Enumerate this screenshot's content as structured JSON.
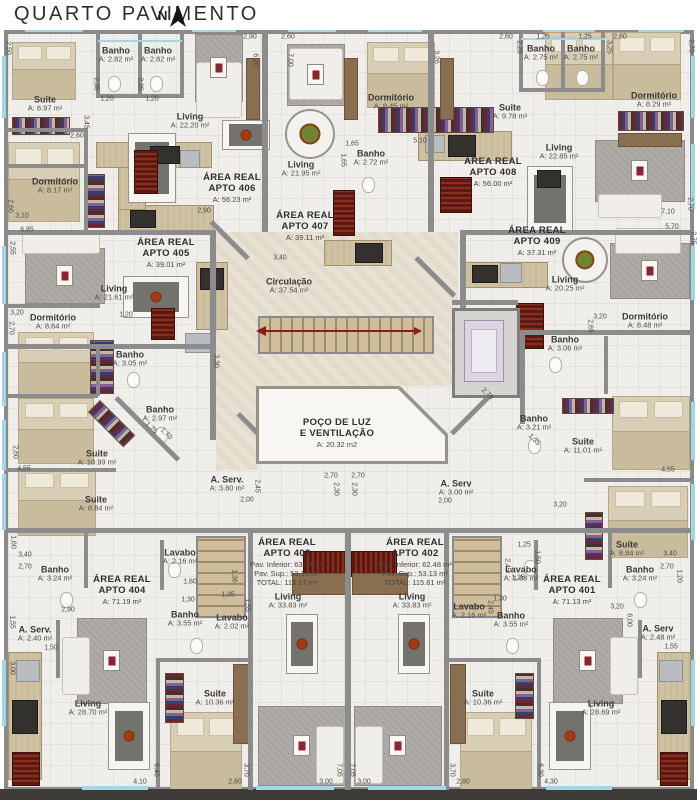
{
  "header": {
    "title": "QUARTO PAVIMENTO",
    "north_label": "N"
  },
  "palette": {
    "wall": "#8c8c8c",
    "floor": "#efeeea",
    "circulation": "#e8e2d5",
    "window": "#a4d7e6",
    "stair": "#cfbd9b",
    "arrow_red": "#8e1b12",
    "label_text": "#3a3a3a"
  },
  "rooms": [
    {
      "name": "Suite",
      "area": "A: 8.97 m²",
      "x": 45,
      "y": 104
    },
    {
      "name": "Banho",
      "area": "A: 2.82 m²",
      "x": 116,
      "y": 55
    },
    {
      "name": "Banho",
      "area": "A: 2.82 m²",
      "x": 158,
      "y": 55
    },
    {
      "name": "Living",
      "area": "A: 22.20 m²",
      "x": 190,
      "y": 121
    },
    {
      "name": "Dormitório",
      "area": "A: 8.17 m²",
      "x": 55,
      "y": 186
    },
    {
      "name": "Living",
      "area": "A: 21.95 m²",
      "x": 301,
      "y": 169
    },
    {
      "name": "Banho",
      "area": "A: 2.72 m²",
      "x": 371,
      "y": 158
    },
    {
      "name": "Dormitório",
      "area": "A: 8.45 m²",
      "x": 391,
      "y": 102
    },
    {
      "name": "Suite",
      "area": "A: 9.78 m²",
      "x": 510,
      "y": 112
    },
    {
      "name": "Banho",
      "area": "A: 2.75 m²",
      "x": 541,
      "y": 53
    },
    {
      "name": "Banho",
      "area": "A: 2.75 m²",
      "x": 581,
      "y": 53
    },
    {
      "name": "Dormitório",
      "area": "A: 8.29 m²",
      "x": 654,
      "y": 100
    },
    {
      "name": "Living",
      "area": "A: 22.85 m²",
      "x": 559,
      "y": 152
    },
    {
      "name": "Living",
      "area": "A: 21.61 m²",
      "x": 114,
      "y": 293
    },
    {
      "name": "Circulação",
      "area": "A: 37.54 m²",
      "x": 289,
      "y": 286
    },
    {
      "name": "Living",
      "area": "A: 20.25 m²",
      "x": 565,
      "y": 284
    },
    {
      "name": "Dormitório",
      "area": "A: 8.64 m²",
      "x": 53,
      "y": 322
    },
    {
      "name": "Banho",
      "area": "A: 3.05 m²",
      "x": 130,
      "y": 359
    },
    {
      "name": "Banho",
      "area": "A: 2.97 m²",
      "x": 160,
      "y": 414
    },
    {
      "name": "Banho",
      "area": "A: 3.06 m²",
      "x": 565,
      "y": 344
    },
    {
      "name": "Dormitório",
      "area": "A: 8.48 m²",
      "x": 645,
      "y": 321
    },
    {
      "name": "Banho",
      "area": "A: 3.21 m²",
      "x": 534,
      "y": 423
    },
    {
      "name": "Suite",
      "area": "A: 10.99 m²",
      "x": 97,
      "y": 458
    },
    {
      "name": "Suite",
      "area": "A: 11.01 m²",
      "x": 583,
      "y": 446
    },
    {
      "name": "A. Serv.",
      "area": "A: 3.80 m²",
      "x": 227,
      "y": 484
    },
    {
      "name": "A. Serv",
      "area": "A: 3.00 m²",
      "x": 456,
      "y": 488
    },
    {
      "name": "Suite",
      "area": "A: 8.84 m²",
      "x": 96,
      "y": 504
    },
    {
      "name": "Suite",
      "area": "A: 8.84 m²",
      "x": 627,
      "y": 549
    },
    {
      "name": "Lavabo",
      "area": "A: 2.16 m²",
      "x": 180,
      "y": 557
    },
    {
      "name": "Banho",
      "area": "A: 3.24 m²",
      "x": 55,
      "y": 574
    },
    {
      "name": "Banho",
      "area": "A: 3.24 m²",
      "x": 640,
      "y": 574
    },
    {
      "name": "Lavabo",
      "area": "A: 1.88 m²",
      "x": 521,
      "y": 574
    },
    {
      "name": "Banho",
      "area": "A: 3.55 m²",
      "x": 185,
      "y": 619
    },
    {
      "name": "Banho",
      "area": "A: 3.55 m²",
      "x": 511,
      "y": 620
    },
    {
      "name": "Lavabo",
      "area": "A: 2.02 m²",
      "x": 232,
      "y": 622
    },
    {
      "name": "Lavabo",
      "area": "A: 2.16 m²",
      "x": 469,
      "y": 611
    },
    {
      "name": "A. Serv.",
      "area": "A: 2.40 m²",
      "x": 35,
      "y": 634
    },
    {
      "name": "A. Serv",
      "area": "A: 2.48 m²",
      "x": 658,
      "y": 633
    },
    {
      "name": "Living",
      "area": "A: 33.83 m²",
      "x": 288,
      "y": 601
    },
    {
      "name": "Living",
      "area": "A: 33.83 m²",
      "x": 412,
      "y": 601
    },
    {
      "name": "Living",
      "area": "A: 28.70 m²",
      "x": 88,
      "y": 708
    },
    {
      "name": "Living",
      "area": "A: 28.69 m²",
      "x": 601,
      "y": 708
    },
    {
      "name": "Suite",
      "area": "A: 10.36 m²",
      "x": 215,
      "y": 698
    },
    {
      "name": "Suite",
      "area": "A: 10.36 m²",
      "x": 483,
      "y": 698
    }
  ],
  "apartments": [
    {
      "lines": [
        "ÁREA REAL",
        "APTO 406",
        "A: 56.23 m²"
      ],
      "x": 232,
      "y": 188
    },
    {
      "lines": [
        "ÁREA REAL",
        "APTO 407",
        "A: 39.11 m²"
      ],
      "x": 305,
      "y": 226
    },
    {
      "lines": [
        "ÁREA REAL",
        "APTO 408",
        "A: 56.00 m²"
      ],
      "x": 493,
      "y": 172
    },
    {
      "lines": [
        "ÁREA REAL",
        "APTO 405",
        "A: 39.01 m²"
      ],
      "x": 166,
      "y": 253
    },
    {
      "lines": [
        "ÁREA REAL",
        "APTO 409",
        "A: 37.31 m²"
      ],
      "x": 537,
      "y": 241
    },
    {
      "lines": [
        "ÁREA REAL",
        "APTO 404",
        "A: 71.19 m²"
      ],
      "x": 122,
      "y": 590
    },
    {
      "lines": [
        "ÁREA REAL",
        "APTO 401",
        "A: 71.13 m²"
      ],
      "x": 572,
      "y": 590
    },
    {
      "lines": [
        "ÁREA REAL",
        "APTO 403",
        "Pav. Inferior: 63.04 m²",
        "Pav. Sup.: 53.13 m²",
        "TOTAL: 116.17 m²"
      ],
      "x": 287,
      "y": 562
    },
    {
      "lines": [
        "ÁREA REAL",
        "APTO 402",
        "Pav. Inferior: 62.48 m²",
        "Pav. Sup.: 53.13 m²",
        "TOTAL: 115.61 m²"
      ],
      "x": 415,
      "y": 562
    },
    {
      "lines": [
        "POÇO DE LUZ",
        "E VENTILAÇÃO",
        "A: 20.32 m2"
      ],
      "x": 337,
      "y": 433
    }
  ],
  "dimensions": [
    {
      "t": "2,90",
      "x": 250,
      "y": 37
    },
    {
      "t": "2,60",
      "x": 288,
      "y": 37
    },
    {
      "t": "2,60",
      "x": 506,
      "y": 37
    },
    {
      "t": "1,25",
      "x": 543,
      "y": 37
    },
    {
      "t": "1,25",
      "x": 585,
      "y": 37
    },
    {
      "t": "2,60",
      "x": 620,
      "y": 37
    },
    {
      "t": "6,20",
      "x": 255,
      "y": 60,
      "r": 90
    },
    {
      "t": "7,00",
      "x": 290,
      "y": 60,
      "r": 90
    },
    {
      "t": "3,26",
      "x": 436,
      "y": 57,
      "r": 90
    },
    {
      "t": "2,20",
      "x": 519,
      "y": 47,
      "r": 90
    },
    {
      "t": "3,25",
      "x": 609,
      "y": 47,
      "r": 90
    },
    {
      "t": "2,70",
      "x": 691,
      "y": 46,
      "r": 90
    },
    {
      "t": "1,20",
      "x": 107,
      "y": 99
    },
    {
      "t": "1,20",
      "x": 152,
      "y": 99
    },
    {
      "t": "2,35",
      "x": 96,
      "y": 84,
      "r": 90
    },
    {
      "t": "2,35",
      "x": 140,
      "y": 84,
      "r": 90
    },
    {
      "t": "3,45",
      "x": 86,
      "y": 122,
      "r": 90
    },
    {
      "t": "2,60",
      "x": 77,
      "y": 136
    },
    {
      "t": "1,65",
      "x": 352,
      "y": 144
    },
    {
      "t": "1,65",
      "x": 343,
      "y": 160,
      "r": 90
    },
    {
      "t": "5,10",
      "x": 420,
      "y": 141
    },
    {
      "t": "3,40",
      "x": 280,
      "y": 258
    },
    {
      "t": "2,90",
      "x": 204,
      "y": 211
    },
    {
      "t": "2,50",
      "x": 8,
      "y": 48,
      "r": 90
    },
    {
      "t": "2,60",
      "x": 10,
      "y": 206,
      "r": 90
    },
    {
      "t": "3,10",
      "x": 22,
      "y": 216
    },
    {
      "t": "6,85",
      "x": 27,
      "y": 230
    },
    {
      "t": "2,55",
      "x": 12,
      "y": 248,
      "r": 90
    },
    {
      "t": "3,20",
      "x": 17,
      "y": 313
    },
    {
      "t": "2,70",
      "x": 11,
      "y": 328,
      "r": 90
    },
    {
      "t": "1,20",
      "x": 126,
      "y": 315
    },
    {
      "t": "3,30",
      "x": 216,
      "y": 361,
      "r": 90
    },
    {
      "t": "1,75",
      "x": 151,
      "y": 428,
      "r": 45
    },
    {
      "t": "1,70",
      "x": 166,
      "y": 434,
      "r": 45
    },
    {
      "t": "4,55",
      "x": 24,
      "y": 469
    },
    {
      "t": "2,60",
      "x": 15,
      "y": 452,
      "r": 90
    },
    {
      "t": "1,60",
      "x": 13,
      "y": 542,
      "r": 90
    },
    {
      "t": "4,55",
      "x": 668,
      "y": 470
    },
    {
      "t": "1,35",
      "x": 534,
      "y": 440,
      "r": 45
    },
    {
      "t": "3,20",
      "x": 600,
      "y": 317
    },
    {
      "t": "2,65",
      "x": 590,
      "y": 326,
      "r": 90
    },
    {
      "t": "7,10",
      "x": 668,
      "y": 212
    },
    {
      "t": "2,70",
      "x": 690,
      "y": 204,
      "r": 90
    },
    {
      "t": "5,70",
      "x": 672,
      "y": 227
    },
    {
      "t": "2,75",
      "x": 693,
      "y": 238,
      "r": 90
    },
    {
      "t": "2,78",
      "x": 487,
      "y": 394,
      "r": 45
    },
    {
      "t": "2,70",
      "x": 331,
      "y": 476
    },
    {
      "t": "2,70",
      "x": 358,
      "y": 476
    },
    {
      "t": "2,30",
      "x": 336,
      "y": 489,
      "r": 90
    },
    {
      "t": "2,30",
      "x": 354,
      "y": 489,
      "r": 90
    },
    {
      "t": "2,00",
      "x": 247,
      "y": 500
    },
    {
      "t": "2,00",
      "x": 445,
      "y": 501
    },
    {
      "t": "2,45",
      "x": 257,
      "y": 486,
      "r": 90
    },
    {
      "t": "2,45",
      "x": 507,
      "y": 565,
      "r": 90
    },
    {
      "t": "1,25",
      "x": 518,
      "y": 578
    },
    {
      "t": "3,20",
      "x": 560,
      "y": 505
    },
    {
      "t": "3,40",
      "x": 25,
      "y": 555
    },
    {
      "t": "2,70",
      "x": 25,
      "y": 567
    },
    {
      "t": "2,90",
      "x": 68,
      "y": 610
    },
    {
      "t": "1,55",
      "x": 12,
      "y": 622,
      "r": 90
    },
    {
      "t": "1,50",
      "x": 51,
      "y": 648
    },
    {
      "t": "3,00",
      "x": 12,
      "y": 668,
      "r": 90
    },
    {
      "t": "3,40",
      "x": 670,
      "y": 554
    },
    {
      "t": "2,70",
      "x": 667,
      "y": 567
    },
    {
      "t": "1,20",
      "x": 679,
      "y": 576,
      "r": 90
    },
    {
      "t": "3,20",
      "x": 617,
      "y": 607
    },
    {
      "t": "6,00",
      "x": 629,
      "y": 620,
      "r": 90
    },
    {
      "t": "1,55",
      "x": 671,
      "y": 647
    },
    {
      "t": "1,35",
      "x": 228,
      "y": 595
    },
    {
      "t": "1,55",
      "x": 247,
      "y": 605,
      "r": 90
    },
    {
      "t": "1,80",
      "x": 190,
      "y": 582
    },
    {
      "t": "1,30",
      "x": 188,
      "y": 600
    },
    {
      "t": "1,36",
      "x": 234,
      "y": 576,
      "r": 90
    },
    {
      "t": "1,25",
      "x": 524,
      "y": 545
    },
    {
      "t": "1,50",
      "x": 537,
      "y": 557,
      "r": 90
    },
    {
      "t": "1,30",
      "x": 500,
      "y": 599
    },
    {
      "t": "2,45",
      "x": 490,
      "y": 607,
      "r": 90
    },
    {
      "t": "4,10",
      "x": 140,
      "y": 782
    },
    {
      "t": "6,40",
      "x": 156,
      "y": 770,
      "r": 90
    },
    {
      "t": "2,80",
      "x": 235,
      "y": 782
    },
    {
      "t": "3,70",
      "x": 246,
      "y": 770,
      "r": 90
    },
    {
      "t": "3,00",
      "x": 326,
      "y": 782
    },
    {
      "t": "7,05",
      "x": 339,
      "y": 770,
      "r": 90
    },
    {
      "t": "7,05",
      "x": 352,
      "y": 770,
      "r": 90
    },
    {
      "t": "3,00",
      "x": 364,
      "y": 782
    },
    {
      "t": "3,70",
      "x": 452,
      "y": 770,
      "r": 90
    },
    {
      "t": "2,80",
      "x": 463,
      "y": 782
    },
    {
      "t": "6,30",
      "x": 540,
      "y": 770,
      "r": 90
    },
    {
      "t": "4,30",
      "x": 551,
      "y": 782
    }
  ]
}
